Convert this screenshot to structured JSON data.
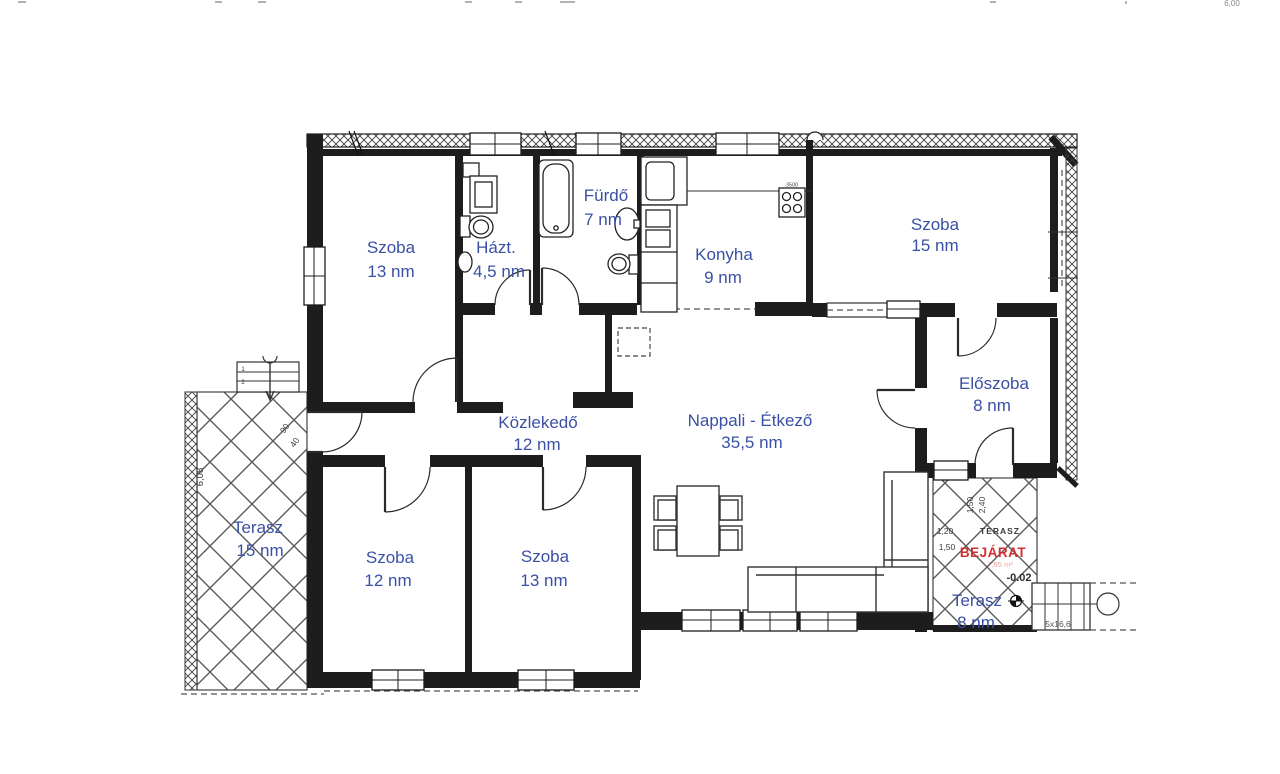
{
  "rooms": [
    {
      "id": "szoba-top-left",
      "name": "Szoba",
      "area": "13 nm"
    },
    {
      "id": "hazt",
      "name": "Házt.",
      "area": "4,5 nm"
    },
    {
      "id": "furdo",
      "name": "Fürdő",
      "area": "7 nm"
    },
    {
      "id": "konyha",
      "name": "Konyha",
      "area": "9 nm"
    },
    {
      "id": "szoba-top-right",
      "name": "Szoba",
      "area": "15 nm"
    },
    {
      "id": "eloszoba",
      "name": "Előszoba",
      "area": "8 nm"
    },
    {
      "id": "nappali-etkezo",
      "name": "Nappali - Étkező",
      "area": "35,5 nm"
    },
    {
      "id": "kozlekedo",
      "name": "Közlekedő",
      "area": "12 nm"
    },
    {
      "id": "szoba-bottom-left",
      "name": "Szoba",
      "area": "12 nm"
    },
    {
      "id": "szoba-bottom-mid",
      "name": "Szoba",
      "area": "13 nm"
    },
    {
      "id": "terasz-left",
      "name": "Terasz",
      "area": "15 nm"
    },
    {
      "id": "terasz-right",
      "name": "Terasz",
      "area": "8 nm"
    }
  ],
  "annotations": {
    "entrance": "BEJÁRAT",
    "entrance_area": "7,85 m²",
    "terrace_caption": "TERASZ",
    "floor_level": "-0.02",
    "stair_spec": "5x16,6",
    "stove_spec": "3500"
  },
  "dimensions": {
    "terrace_height": "6,08",
    "door_width": "90",
    "wall_width": "40",
    "dim_1_20": "1,20",
    "dim_1_50": "1,50",
    "dim_1_50_v": "1,50",
    "dim_2_40_v": "2,40",
    "top_edge_clipped": "6,00",
    "garden_step_1": "1",
    "garden_step_2": "2"
  },
  "colors": {
    "room_label_blue": "#3a50a5",
    "entrance_red": "#d42f2f",
    "wall_black": "#1d1d1d",
    "hatch_gray": "#5a5a5a"
  }
}
